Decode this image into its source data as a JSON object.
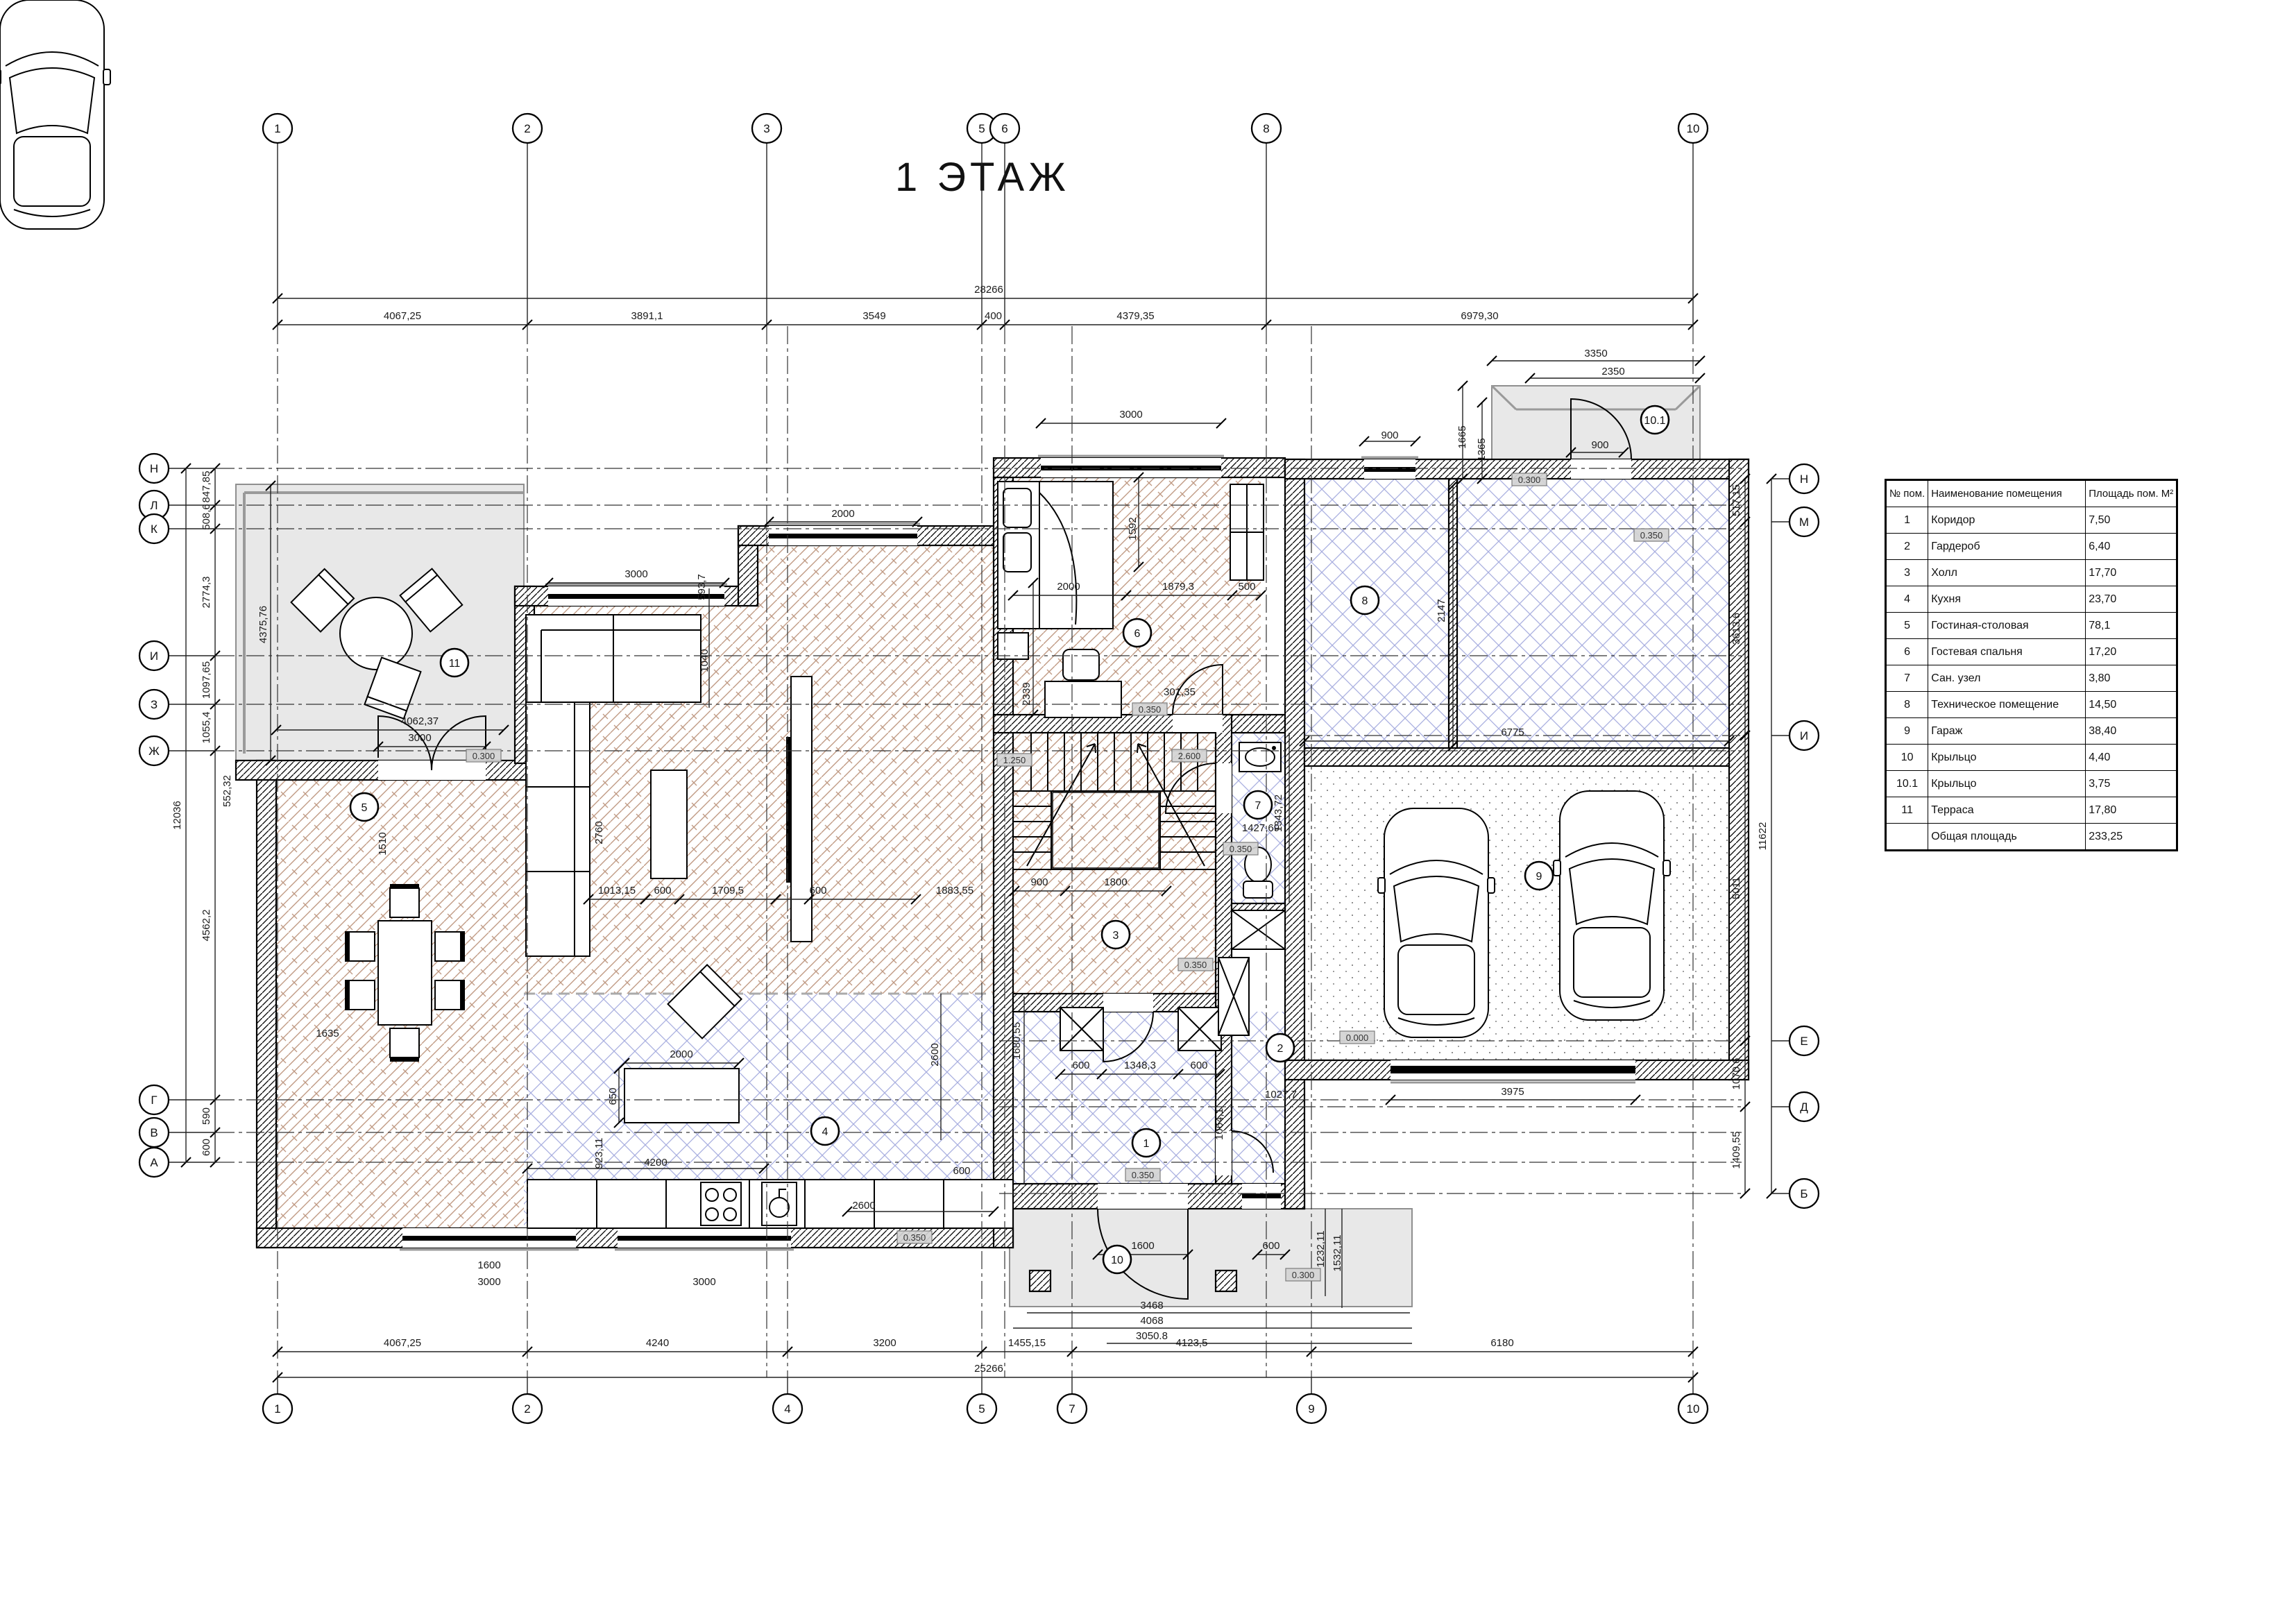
{
  "title": "1 ЭТАЖ",
  "legend_table": {
    "headers": [
      "№ пом.",
      "Наименование помещения",
      "Площадь пом. М²"
    ],
    "rows": [
      [
        "1",
        "Коридор",
        "7,50"
      ],
      [
        "2",
        "Гардероб",
        "6,40"
      ],
      [
        "3",
        "Холл",
        "17,70"
      ],
      [
        "4",
        "Кухня",
        "23,70"
      ],
      [
        "5",
        "Гостиная-столовая",
        "78,1"
      ],
      [
        "6",
        "Гостевая спальня",
        "17,20"
      ],
      [
        "7",
        "Сан. узел",
        "3,80"
      ],
      [
        "8",
        "Техническое помещение",
        "14,50"
      ],
      [
        "9",
        "Гараж",
        "38,40"
      ],
      [
        "10",
        "Крыльцо",
        "4,40"
      ],
      [
        "10.1",
        "Крыльцо",
        "3,75"
      ],
      [
        "11",
        "Терраса",
        "17,80"
      ],
      [
        "",
        "Общая площадь",
        "233,25"
      ]
    ]
  },
  "axes": {
    "top": [
      "1",
      "2",
      "3",
      "5",
      "6",
      "8",
      "10"
    ],
    "bottom": [
      "1",
      "2",
      "4",
      "5",
      "7",
      "9",
      "10"
    ],
    "left": [
      "Н",
      "Л",
      "К",
      "И",
      "З",
      "Ж",
      "Г",
      "В",
      "А"
    ],
    "right": [
      "Н",
      "М",
      "И",
      "Е",
      "Д",
      "Б"
    ]
  },
  "dims": {
    "top_segments": [
      "4067,25",
      "3891,1",
      "3549",
      "400",
      "4379,35",
      "6979,30"
    ],
    "top_total": "28266",
    "bottom_segments": [
      "4067,25",
      "4240",
      "3200",
      "1455,15",
      "4123,5",
      "6180"
    ],
    "bottom_total": "25266",
    "left_segments": [
      "847,85",
      "508,6",
      "2774,3",
      "1097,65",
      "1055,4",
      "4562,2",
      "590",
      "600"
    ],
    "left_total": "12036",
    "right_segments": [
      "517,15",
      "3613,6",
      "5011",
      "1070,6",
      "1409,55"
    ],
    "right_total": "11622",
    "inner": [
      "3000",
      "2000",
      "3000",
      "593,7",
      "1040",
      "2760",
      "1013,15",
      "600",
      "1709,5",
      "600",
      "1883,55",
      "1510",
      "1635",
      "4375,76",
      "4062,37",
      "3000",
      "552,32",
      "2000",
      "650",
      "923,11",
      "4200",
      "2600",
      "600",
      "2600",
      "1600",
      "3000",
      "3000",
      "1592",
      "2000",
      "1879,3",
      "500",
      "2339",
      "301,35",
      "900",
      "1800",
      "1427,69",
      "1343,72",
      "1680,55",
      "600",
      "1348,3",
      "600",
      "1064,1",
      "1027,7",
      "1600",
      "600",
      "3468",
      "4068",
      "3050.8",
      "1232,11",
      "1532,11",
      "6775",
      "2147",
      "3975",
      "3350",
      "2350",
      "1665",
      "1365",
      "900",
      "900"
    ]
  },
  "wall_tags": [
    "0.350",
    "0.350",
    "0.350",
    "0.350",
    "0.350",
    "0.350",
    "0.300",
    "0.300",
    "0.300",
    "1.250",
    "2.600",
    "0.000"
  ],
  "room_markers": [
    "1",
    "2",
    "3",
    "4",
    "5",
    "6",
    "7",
    "8",
    "9",
    "10",
    "10.1",
    "11"
  ]
}
